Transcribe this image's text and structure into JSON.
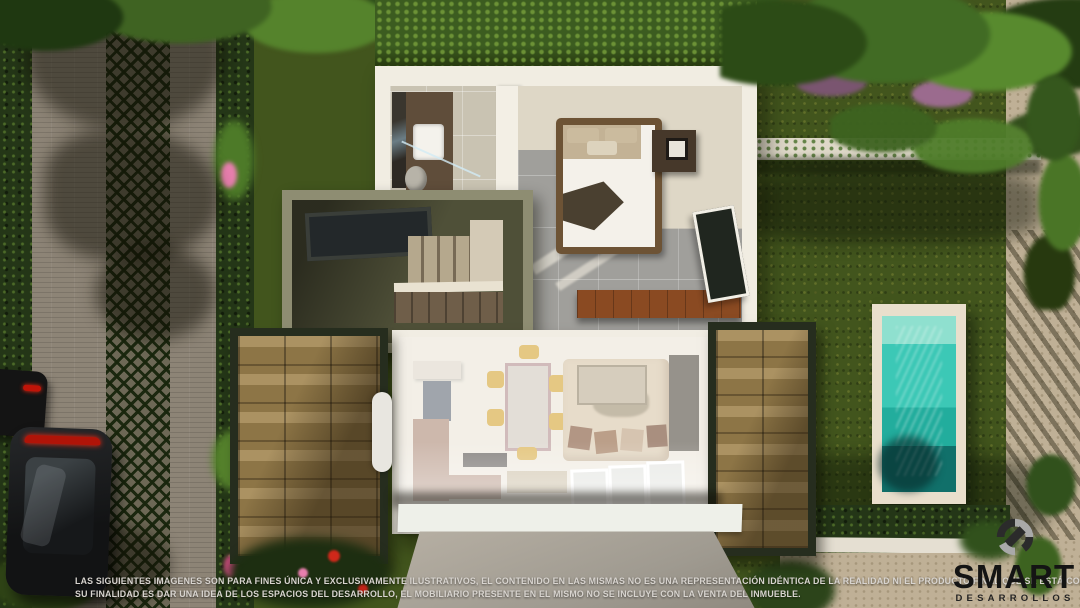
{
  "scene": {
    "type": "aerial-3d-architectural-render",
    "description": "Top-down dollhouse view of a two-storey house: upstairs bathroom and bedroom, open-air olive stair terrace, ghosted ground-floor living-dining-kitchen, woven-wood carport pergolas, rear lawn with plunge pool, paver street with parked cars and tree shadows",
    "objects": [
      "street",
      "grass-paver-strip",
      "parked-cars",
      "hedges",
      "tree-canopy",
      "house",
      "bathroom",
      "bedroom",
      "bed",
      "stair-terrace",
      "living-dining-room",
      "carport-pergola",
      "lawn",
      "pool",
      "garden-path",
      "driveway"
    ]
  },
  "disclaimer": {
    "line1": "LAS SIGUIENTES IMAGENES SON PARA FINES ÚNICA Y EXCLUSIVAMENTE ILUSTRATIVOS, EL CONTENIDO EN LAS MISMAS NO ES UNA REPRESENTACIÓN IDÉNTICA DE LA REALIDAD NI EL PRODUCTO FINAL QUE SE ESTÁ COMERCIALIZANDO,",
    "line2": "SU FINALIDAD ES DAR UNA IDEA DE LOS ESPACIOS DEL DESARROLLO, EL MOBILIARIO PRESENTE EN EL MISMO NO SE INCLUYE CON LA VENTA DEL INMUEBLE."
  },
  "logo": {
    "brand": "SMART",
    "subtitle": "DESARROLLOS",
    "icon": "smart-s-icon"
  },
  "colors": {
    "canopy_green": "#3f6322",
    "lawn_green": "#42551d",
    "hedge_dark": "#243617",
    "street_paver": "#8d8476",
    "grass_paver": "#6d6856",
    "house_wall": "#f1ede2",
    "terrace_olive": "#50513a",
    "deck_weave": "#a28650",
    "bench_wood": "#8a4a22",
    "pool_water": "#2cc0ae",
    "pool_deck": "#e9dfcc",
    "driveway": "#a7a095",
    "car_body": "#1b1d1e",
    "taillight_red": "#c01408",
    "flower_pink": "#e87fae",
    "logo_black": "#151515"
  }
}
